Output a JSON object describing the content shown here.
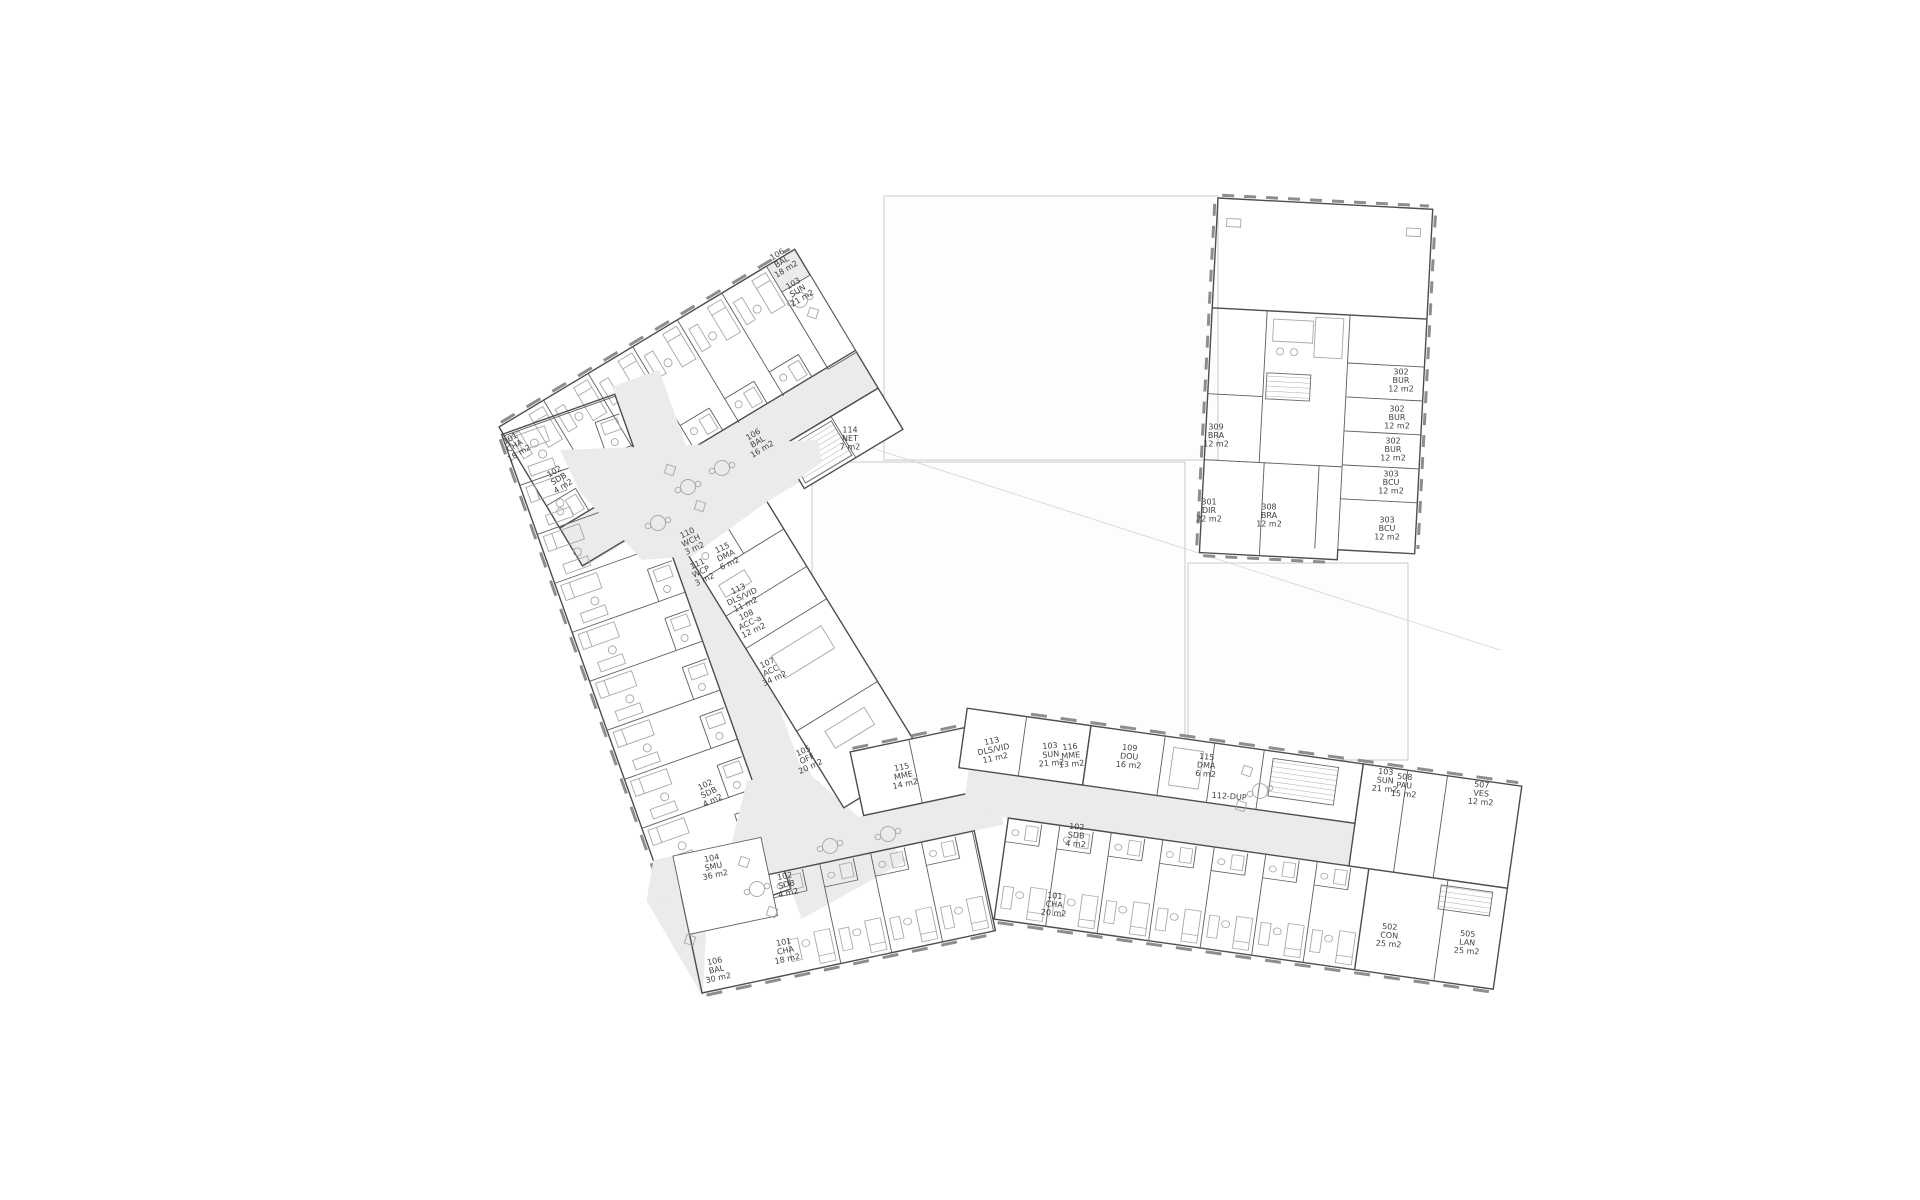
{
  "plan": {
    "type": "architectural-floor-plan",
    "floor_label": "hotel floor plan with three wings and office block",
    "corridor_color": "#ebebeb",
    "wall_color": "#4d4d4d",
    "label_color": "#3f3f3f"
  },
  "rooms": [
    {
      "id": "101",
      "name": "CHA",
      "area": "18 m2",
      "x": 516,
      "y": 448,
      "r": -31
    },
    {
      "id": "102",
      "name": "SDB",
      "area": "4 m2",
      "x": 560,
      "y": 481,
      "r": -31
    },
    {
      "id": "106",
      "name": "BAL",
      "area": "18 m2",
      "x": 783,
      "y": 264,
      "r": -31
    },
    {
      "id": "103",
      "name": "SUN",
      "area": "21 m2",
      "x": 799,
      "y": 293,
      "r": -31
    },
    {
      "id": "106",
      "name": "BAL",
      "area": "16 m2",
      "x": 759,
      "y": 444,
      "r": -31
    },
    {
      "id": "114",
      "name": "NET",
      "area": "7 m2",
      "x": 850,
      "y": 441,
      "r": 0
    },
    {
      "id": "110",
      "name": "WCH",
      "area": "3 m2",
      "x": 692,
      "y": 543,
      "r": -25
    },
    {
      "id": "115",
      "name": "DMA",
      "area": "6 m2",
      "x": 727,
      "y": 558,
      "r": -25
    },
    {
      "id": "111",
      "name": "WCP",
      "area": "3 m2",
      "x": 702,
      "y": 574,
      "r": -25
    },
    {
      "id": "113",
      "name": "DLS/VID",
      "area": "11 m2",
      "x": 743,
      "y": 599,
      "r": -25
    },
    {
      "id": "108",
      "name": "ACC-a",
      "area": "12 m2",
      "x": 751,
      "y": 625,
      "r": -25
    },
    {
      "id": "107",
      "name": "ACC",
      "area": "34 m2",
      "x": 772,
      "y": 673,
      "r": -25
    },
    {
      "id": "105",
      "name": "OFF",
      "area": "20 m2",
      "x": 808,
      "y": 761,
      "r": -25
    },
    {
      "id": "102",
      "name": "SDB",
      "area": "4 m2",
      "x": 710,
      "y": 795,
      "r": -25
    },
    {
      "id": "104",
      "name": "SMU",
      "area": "36 m2",
      "x": 714,
      "y": 869,
      "r": -12
    },
    {
      "id": "102",
      "name": "SDB",
      "area": "4 m2",
      "x": 787,
      "y": 887,
      "r": -12
    },
    {
      "id": "101",
      "name": "CHA",
      "area": "18 m2",
      "x": 786,
      "y": 953,
      "r": -12
    },
    {
      "id": "106",
      "name": "BAL",
      "area": "30 m2",
      "x": 717,
      "y": 972,
      "r": -12
    },
    {
      "id": "115",
      "name": "MME",
      "area": "14 m2",
      "x": 904,
      "y": 778,
      "r": -12
    },
    {
      "id": "113",
      "name": "DLS/VID",
      "area": "11 m2",
      "x": 994,
      "y": 752,
      "r": -12
    },
    {
      "id": "103",
      "name": "SUN",
      "area": "21 m2",
      "x": 1051,
      "y": 757,
      "r": -5
    },
    {
      "id": "116",
      "name": "MME",
      "area": "13 m2",
      "x": 1071,
      "y": 758,
      "r": -5
    },
    {
      "id": "109",
      "name": "DOU",
      "area": "16 m2",
      "x": 1129,
      "y": 759,
      "r": 4
    },
    {
      "id": "115",
      "name": "DMA",
      "area": "6 m2",
      "x": 1206,
      "y": 768,
      "r": 4
    },
    {
      "id": "112-DUP",
      "name": "",
      "area": "",
      "x": 1229,
      "y": 799,
      "r": 4
    },
    {
      "id": "103",
      "name": "SUN",
      "area": "21 m2",
      "x": 1385,
      "y": 783,
      "r": 4
    },
    {
      "id": "508",
      "name": "PAU",
      "area": "15 m2",
      "x": 1404,
      "y": 788,
      "r": 4
    },
    {
      "id": "507",
      "name": "VES",
      "area": "12 m2",
      "x": 1481,
      "y": 796,
      "r": 4
    },
    {
      "id": "102",
      "name": "SDB",
      "area": "4 m2",
      "x": 1076,
      "y": 838,
      "r": 4
    },
    {
      "id": "101",
      "name": "CHA",
      "area": "20 m2",
      "x": 1054,
      "y": 907,
      "r": 4
    },
    {
      "id": "502",
      "name": "CON",
      "area": "25 m2",
      "x": 1389,
      "y": 938,
      "r": 4
    },
    {
      "id": "505",
      "name": "LAN",
      "area": "25 m2",
      "x": 1467,
      "y": 945,
      "r": 4
    },
    {
      "id": "309",
      "name": "BRA",
      "area": "12 m2",
      "x": 1216,
      "y": 438,
      "r": 0
    },
    {
      "id": "301",
      "name": "DIR",
      "area": "22 m2",
      "x": 1209,
      "y": 513,
      "r": 0
    },
    {
      "id": "308",
      "name": "BRA",
      "area": "12 m2",
      "x": 1269,
      "y": 518,
      "r": 0
    },
    {
      "id": "302",
      "name": "BUR",
      "area": "12 m2",
      "x": 1401,
      "y": 383,
      "r": 0
    },
    {
      "id": "302",
      "name": "BUR",
      "area": "12 m2",
      "x": 1397,
      "y": 420,
      "r": 0
    },
    {
      "id": "302",
      "name": "BUR",
      "area": "12 m2",
      "x": 1393,
      "y": 452,
      "r": 0
    },
    {
      "id": "303",
      "name": "BCU",
      "area": "12 m2",
      "x": 1391,
      "y": 485,
      "r": 0
    },
    {
      "id": "303",
      "name": "BCU",
      "area": "12 m2",
      "x": 1387,
      "y": 531,
      "r": 0
    }
  ]
}
